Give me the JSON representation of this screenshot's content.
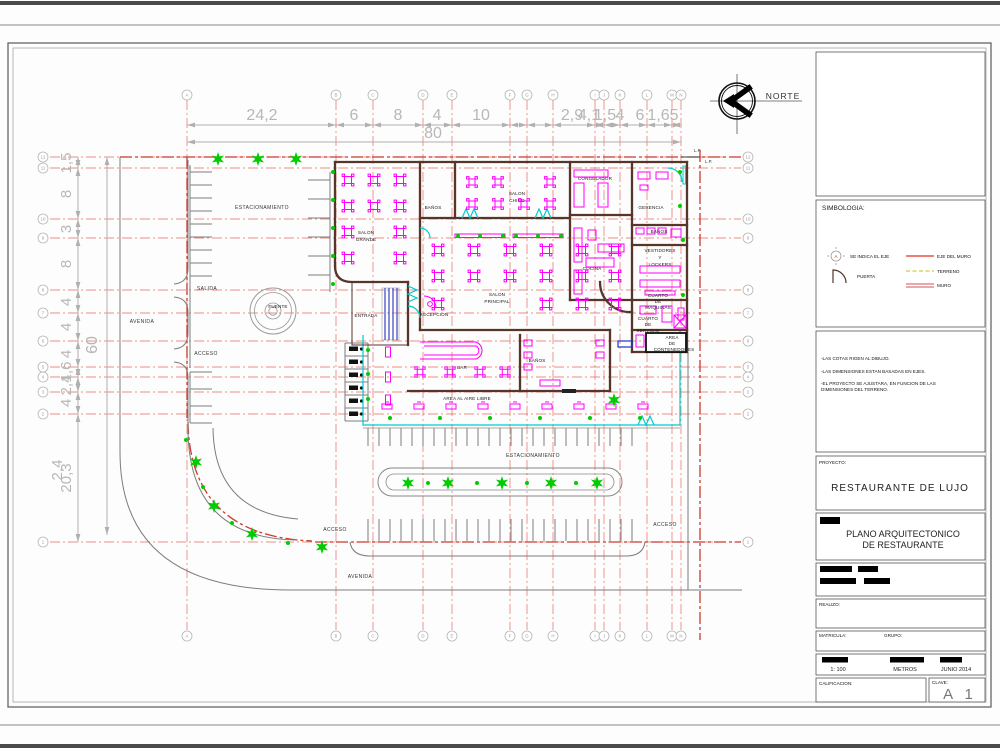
{
  "palette": {
    "axis_red": "#e2695f",
    "property_red": "#cc3a2e",
    "dim_gray": "#b7b7b7",
    "wall_brown": "#56352b",
    "furniture_magenta": "#ff00ff",
    "vegetation_green": "#00cc00",
    "door_cyan": "#00cccc",
    "ramp_blue": "#3b43c4"
  },
  "north": {
    "label": "NORTE"
  },
  "lp_label": "L.P.",
  "grid": {
    "letters": [
      "A",
      "B",
      "C",
      "D",
      "E",
      "F",
      "G",
      "H",
      "I",
      "J",
      "K",
      "L",
      "M",
      "N"
    ],
    "numbers": [
      "12",
      "11",
      "10",
      "9",
      "8",
      "7",
      "6",
      "5",
      "4",
      "3",
      "2",
      "1"
    ]
  },
  "dimensions": {
    "top_segments": [
      "24,2",
      "6",
      "8",
      "4",
      "10"
    ],
    "top_cluster": [
      "2,9",
      "4,1",
      "1,5",
      "4",
      "6",
      "1,65"
    ],
    "top_total": "80",
    "left_segments": [
      "1,5",
      "8",
      "3",
      "8",
      "4",
      "4",
      "4",
      "1,6",
      "2,4",
      "4",
      "20,3"
    ],
    "left_extra": "2,4",
    "left_total": "60"
  },
  "site": {
    "estacionamiento_top": "ESTACIONAMIENTO",
    "estacionamiento_bottom": "ESTACIONAMIENTO",
    "salida": "SALIDA",
    "avenida_left": "AVENIDA",
    "avenida_bottom": "AVENIDA",
    "acceso_left": "ACCESO",
    "acceso_bottom_left": "ACCESO",
    "acceso_bottom_right": "ACCESO",
    "fuente": "FUENTE"
  },
  "rooms": {
    "salon_grande": [
      "SALON",
      "GRANDE"
    ],
    "banos_1": "BAÑOS",
    "salon_chico": [
      "SALON",
      "CHICO"
    ],
    "congelador": "CONGELADOR",
    "gerencia": "GERENCIA",
    "banos_2": "BAÑOS",
    "vestidores": [
      "VESTIDORES",
      "Y",
      "LOCKERS"
    ],
    "cocina": "COCINA",
    "cuarto_maquinas": [
      "CUARTO",
      "DE",
      "MAQUINAS"
    ],
    "cuarto_servicio": [
      "CUARTO",
      "DE",
      "SERVICIO"
    ],
    "area_contenedores": [
      "AREA",
      "DE",
      "CONTENEDORES"
    ],
    "recepcion": "RECEPCION",
    "entrada": "ENTRADA",
    "salon_principal": [
      "SALON",
      "PRINCIPAL"
    ],
    "bar": "BAR",
    "banos_3": "BAÑOS",
    "area_aire_libre": "AREA AL AIRE LIBRE"
  },
  "titleblock": {
    "simbologia_title": "SIMBOLOGIA:",
    "legend": {
      "axis_letter": "A",
      "se_indica": "SE INDICA EL EJE",
      "puerta": "PUERTA",
      "eje_muro": "EJE DEL MURO",
      "terreno": "TERRENO",
      "muro": "MURO"
    },
    "notes": [
      "-LAS COTAS RIGEN AL DIBUJO.",
      "-LAS DIMENSIONES ESTAN BASADAS EN EJES.",
      "-EL PROYECTO SE AJUSTARA, EN FUNCION DE LAS",
      "DIMENSIONES DEL TERRENO."
    ],
    "proyecto_label": "PROYECTO:",
    "proyecto_nombre": "RESTAURANTE DE LUJO",
    "plano_titulo": [
      "PLANO ARQUITECTONICO",
      "DE RESTAURANTE"
    ],
    "realizo": "REALIZO:",
    "matricula": "MATRICULA:",
    "grupo": "GRUPO:",
    "escala": "1: 100",
    "unidades": "METROS",
    "fecha": "JUNIO 2014",
    "calificacion": "CALIFICACION:",
    "clave_label": "CLAVE:",
    "clave_valor": "A 1"
  }
}
